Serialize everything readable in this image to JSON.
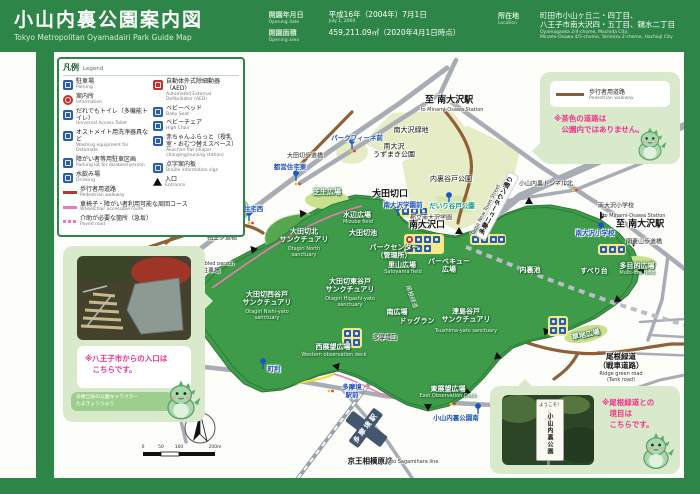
{
  "header": {
    "title_jp": "小山内裏公園案内図",
    "title_en": "Tokyo Metropolitan Oyamadairi Park Guide Map",
    "opening_date_label_jp": "開園年月日",
    "opening_date_label_en": "Opening date",
    "opening_date_value": "平成16年（2004年）7月1日",
    "opening_date_value_en": "July 1, 2004",
    "area_label_jp": "開園面積",
    "area_label_en": "Opening area",
    "area_value": "459,211.09㎡（2020年4月1日時点）",
    "location_label_jp": "所在地",
    "location_label_en": "Location",
    "location_line1": "町田市小山ヶ丘二・四丁目、",
    "location_line2": "八王子市南大沢四・五丁目、鑓水二丁目",
    "location_en_line1": "Oyamagaoka 2/4-chome, Machida City;",
    "location_en_line2": "Minami-Osawa 4/5-chome, Yarimizu 2-chome, Hachioji City"
  },
  "legend": {
    "title_jp": "凡例",
    "title_en": "Legend",
    "col_left": [
      {
        "icon": "parking",
        "jp": "駐車場",
        "en": "Parking"
      },
      {
        "icon": "info",
        "jp": "案内所",
        "en": "Information"
      },
      {
        "icon": "toilet",
        "jp": "だれでもトイレ（多機能トイレ）",
        "en": "Universal Access Toilet"
      },
      {
        "icon": "ostomate",
        "jp": "オストメイト用洗浄器具など",
        "en": "Washing equipment for Ostomate"
      },
      {
        "icon": "disabled-parking",
        "jp": "障がい者等用駐車区画",
        "en": "Parking lot for disabled person"
      },
      {
        "icon": "drinking",
        "jp": "水飲み場",
        "en": "Drinking"
      },
      {
        "icon": "line-red",
        "jp": "歩行者用道路",
        "en": "Pedestrian walkway"
      }
    ],
    "col_right": [
      {
        "icon": "aed",
        "jp": "自動体外式除細動器（AED）",
        "en": "Automated External Defibrillator (AED)"
      },
      {
        "icon": "baby-bed",
        "jp": "ベビーベッド",
        "en": "Baby Seat"
      },
      {
        "icon": "baby-chair",
        "jp": "ベビーチェア",
        "en": "High Chair"
      },
      {
        "icon": "akachan",
        "jp": "赤ちゃんふらっと（授乳室・おむつ替えスペース）",
        "en": "Akachan flat (diaper changing/nursing station)"
      },
      {
        "icon": "braille",
        "jp": "点字案内板",
        "en": "Braille information sign"
      },
      {
        "icon": "entrance",
        "jp": "入口",
        "en": "Entrance"
      }
    ],
    "full_rows": [
      {
        "icon": "line-pink",
        "jp": "車椅子・障がい者利用可能な周回コース",
        "en": "Wheelchair accessible route"
      },
      {
        "icon": "line-pink-dash",
        "jp": "介助が必要な箇所（急坂）",
        "en": "Paved road"
      }
    ]
  },
  "bubble": {
    "line_jp": "歩行者用道路",
    "line_en": "Pedestrian walkway",
    "note": "※茶色の道路は\n　公園内ではありません。"
  },
  "callout_hachioji": {
    "note": "※八王子市からの入口は\n　こちらです。",
    "caption": "多摩丘陵の公園キャラクター\nたまきょうりゅう"
  },
  "callout_onekondo": {
    "note": "※尾根緑道との\n　境目は\n　こちらです。",
    "sign_top": "ようこそ！",
    "sign_sub": "ここから先は",
    "sign_main": "小山内裏公園"
  },
  "map": {
    "compass_n": "N",
    "labels": [
      {
        "t": "至 南大沢駅",
        "x": 449,
        "y": 101,
        "c": "bkb halo",
        "n": "label-to-minamiosawa-station-top"
      },
      {
        "t": "to Minami-Osawa Station",
        "x": 452,
        "y": 110,
        "c": "enb halo"
      },
      {
        "t": "南大沢緑地",
        "x": 411,
        "y": 130,
        "c": "bk halo",
        "n": "label-minamiosawa-ryokuchi"
      },
      {
        "t": "南大沢\nうずまき公園",
        "x": 394,
        "y": 151,
        "c": "bk halo",
        "n": "label-uzumaki-park"
      },
      {
        "t": "内裏谷戸公園",
        "x": 451,
        "y": 179,
        "c": "bk halo",
        "n": "label-dairiyato-park"
      },
      {
        "t": "大田切歩道橋",
        "x": 305,
        "y": 156,
        "c": "bks halo",
        "n": "label-otagiri-footbridge"
      },
      {
        "t": "パークフィーネ前",
        "x": 357,
        "y": 139,
        "c": "bl halo",
        "n": "bus-stop-parkfine-mae"
      },
      {
        "t": "都営住宅東",
        "x": 290,
        "y": 168,
        "c": "bl halo",
        "n": "bus-stop-toei-jutaku-higashi"
      },
      {
        "t": "都営住宅西",
        "x": 247,
        "y": 210,
        "c": "bl halo",
        "n": "bus-stop-toei-jutaku-nishi"
      },
      {
        "t": "相生歩道橋",
        "x": 222,
        "y": 238,
        "c": "bks halo",
        "n": "label-aioi-footbridge"
      },
      {
        "t": "Parking lot for disabled person",
        "x": 196,
        "y": 264,
        "c": "enb halo"
      },
      {
        "t": "障がい者専用駐車場",
        "x": 193,
        "y": 271,
        "c": "bks halo",
        "n": "label-disabled-parking"
      },
      {
        "t": "鑓水小山口",
        "x": 180,
        "y": 306,
        "c": "bkb halo",
        "n": "label-yarimizukoyama-entrance"
      },
      {
        "t": "鑓水小山\n給水所",
        "x": 153,
        "y": 291,
        "c": "bks halo",
        "n": "label-yarimizukoyama-water"
      },
      {
        "t": "鑓水小山緑地",
        "x": 162,
        "y": 321,
        "c": "bks halo",
        "n": "label-yarimizukoyama-ryokuchi"
      },
      {
        "t": "サレジオ\n高専東",
        "x": 143,
        "y": 361,
        "c": "bks halo",
        "n": "bus-stop-salesio-kosen-higashi"
      },
      {
        "t": "大田切口",
        "x": 390,
        "y": 195,
        "c": "bkb halo",
        "n": "label-otagiri-entrance"
      },
      {
        "t": "南大沢学園前",
        "x": 403,
        "y": 206,
        "c": "bl halo",
        "n": "bus-stop-minamiosawa-gakuen-mae"
      },
      {
        "t": "都立南大沢学園",
        "x": 431,
        "y": 218,
        "c": "bks halo",
        "n": "label-minamiosawa-gakuen"
      },
      {
        "t": "南大沢口",
        "x": 427,
        "y": 226,
        "c": "bkb halo",
        "n": "label-minamiosawa-entrance"
      },
      {
        "t": "だいり谷戸公園",
        "x": 452,
        "y": 207,
        "c": "gr halo",
        "n": "bus-stop-dairiyato-park"
      },
      {
        "t": "小山内裏トンネル北",
        "x": 546,
        "y": 184,
        "c": "bks halo",
        "n": "bus-stop-tunnel-north"
      },
      {
        "t": "南大沢小学校",
        "x": 616,
        "y": 206,
        "c": "bks halo",
        "n": "label-minamiosawa-elementary"
      },
      {
        "t": "to Minami-Osawa Station",
        "x": 634,
        "y": 216,
        "c": "enb halo"
      },
      {
        "t": "至 南大沢駅",
        "x": 640,
        "y": 225,
        "c": "bkb halo",
        "n": "label-to-minamiosawa-station-right"
      },
      {
        "t": "南大沢小学校",
        "x": 595,
        "y": 234,
        "c": "bl halo",
        "n": "bus-stop-minamiosawa-elementary"
      },
      {
        "t": "関東山歩道橋",
        "x": 644,
        "y": 242,
        "c": "bks halo",
        "n": "label-kantoyama-footbridge"
      },
      {
        "t": "多摩ニュータウン通り",
        "x": 497,
        "y": 206,
        "c": "pill",
        "r": -62,
        "n": "label-tama-newtown-street"
      },
      {
        "t": "Tama New Town Street",
        "x": 486,
        "y": 210,
        "c": "enb halo",
        "r": -62
      },
      {
        "t": "芝生広場",
        "x": 327,
        "y": 192,
        "c": "wh",
        "n": "label-lawn-field"
      },
      {
        "t": "水辺広場",
        "x": 357,
        "y": 215,
        "c": "wh",
        "n": "label-mizube-field"
      },
      {
        "t": "Mizube field",
        "x": 358,
        "y": 222,
        "c": "enw"
      },
      {
        "t": "大田切池",
        "x": 363,
        "y": 233,
        "c": "wh",
        "n": "label-otagiri-pond"
      },
      {
        "t": "大田切北\nサンクチュアリ",
        "x": 304,
        "y": 236,
        "c": "wh",
        "n": "label-otagiri-north-sanctuary"
      },
      {
        "t": "Otagiri North\nsanctuary",
        "x": 304,
        "y": 252,
        "c": "enw"
      },
      {
        "t": "大田切西谷戸\nサンクチュアリ",
        "x": 267,
        "y": 299,
        "c": "wh",
        "n": "label-otagiri-nishiyato-sanctuary"
      },
      {
        "t": "Otagiri Nishi-yato\nsanctuary",
        "x": 267,
        "y": 315,
        "c": "enw"
      },
      {
        "t": "大田切東谷戸\nサンクチュアリ",
        "x": 350,
        "y": 286,
        "c": "wh",
        "n": "label-otagiri-higashiyato-sanctuary"
      },
      {
        "t": "Otagiri Higashi-yato\nsanctuary",
        "x": 350,
        "y": 302,
        "c": "enw"
      },
      {
        "t": "パークセンター\n（管理所）",
        "x": 394,
        "y": 252,
        "c": "wh",
        "n": "label-park-center"
      },
      {
        "t": "里山広場",
        "x": 402,
        "y": 265,
        "c": "wh",
        "n": "label-satoyama-field"
      },
      {
        "t": "Satoyama field",
        "x": 403,
        "y": 272,
        "c": "enw"
      },
      {
        "t": "バーベキュー\n広場",
        "x": 449,
        "y": 266,
        "c": "wh",
        "n": "label-barbecue-field"
      },
      {
        "t": "津島谷戸\nサンクチュアリ",
        "x": 466,
        "y": 316,
        "c": "wh",
        "n": "label-tsushima-yato-sanctuary"
      },
      {
        "t": "Tsushima-yato sanctuary",
        "x": 466,
        "y": 331,
        "c": "enw"
      },
      {
        "t": "南広場",
        "x": 397,
        "y": 312,
        "c": "wh",
        "n": "label-south-field"
      },
      {
        "t": "ドッグラン",
        "x": 417,
        "y": 321,
        "c": "wh",
        "n": "label-dog-run"
      },
      {
        "t": "尾根緑道",
        "x": 411,
        "y": 297,
        "c": "whs",
        "r": 70,
        "n": "label-oneryokudo-path"
      },
      {
        "t": "多目的広場",
        "x": 637,
        "y": 266,
        "c": "wh",
        "n": "label-multiuse-field"
      },
      {
        "t": "Multi-use field",
        "x": 637,
        "y": 273,
        "c": "enw"
      },
      {
        "t": "すべり台",
        "x": 594,
        "y": 271,
        "c": "wh",
        "n": "label-slide"
      },
      {
        "t": "内裏池",
        "x": 530,
        "y": 270,
        "c": "wh",
        "n": "label-dairi-pond"
      },
      {
        "t": "草地広場",
        "x": 586,
        "y": 335,
        "c": "wh",
        "r": -12,
        "n": "label-grass-field"
      },
      {
        "t": "西展望広場",
        "x": 333,
        "y": 347,
        "c": "wh",
        "n": "label-west-observation"
      },
      {
        "t": "Western observation deck",
        "x": 334,
        "y": 355,
        "c": "enw"
      },
      {
        "t": "東展望広場",
        "x": 448,
        "y": 389,
        "c": "wh",
        "n": "label-east-observation"
      },
      {
        "t": "East Observation Deck",
        "x": 448,
        "y": 396,
        "c": "enw"
      },
      {
        "t": "多摩境口",
        "x": 385,
        "y": 338,
        "c": "bks halo",
        "n": "label-tamasakai-entrance"
      },
      {
        "t": "町利",
        "x": 274,
        "y": 370,
        "c": "bl halo",
        "n": "bus-stop-machiri"
      },
      {
        "t": "多摩境\n駅前",
        "x": 352,
        "y": 392,
        "c": "bl halo",
        "n": "bus-stop-tamasakai-ekimae"
      },
      {
        "t": "多摩境駅",
        "x": 366,
        "y": 428,
        "c": "sta",
        "r": -53,
        "n": "label-tamasakai-station"
      },
      {
        "t": "京王相模原線",
        "x": 370,
        "y": 461,
        "c": "bkm halo",
        "n": "label-keio-sagamihara-line"
      },
      {
        "t": "Keio Sagamihara line",
        "x": 412,
        "y": 462,
        "c": "enb halo"
      },
      {
        "t": "小山内裏公園南",
        "x": 456,
        "y": 419,
        "c": "bl halo",
        "n": "bus-stop-oyamadairi-park-south"
      },
      {
        "t": "尾根緑道\n（戦車道路）",
        "x": 621,
        "y": 361,
        "c": "bkm halo",
        "n": "label-ridge-green-road"
      },
      {
        "t": "Ridge green road\n(Tank road)",
        "x": 621,
        "y": 377,
        "c": "enb halo"
      }
    ]
  },
  "scale": {
    "ticks": [
      "0",
      "50",
      "100",
      "200m"
    ]
  }
}
